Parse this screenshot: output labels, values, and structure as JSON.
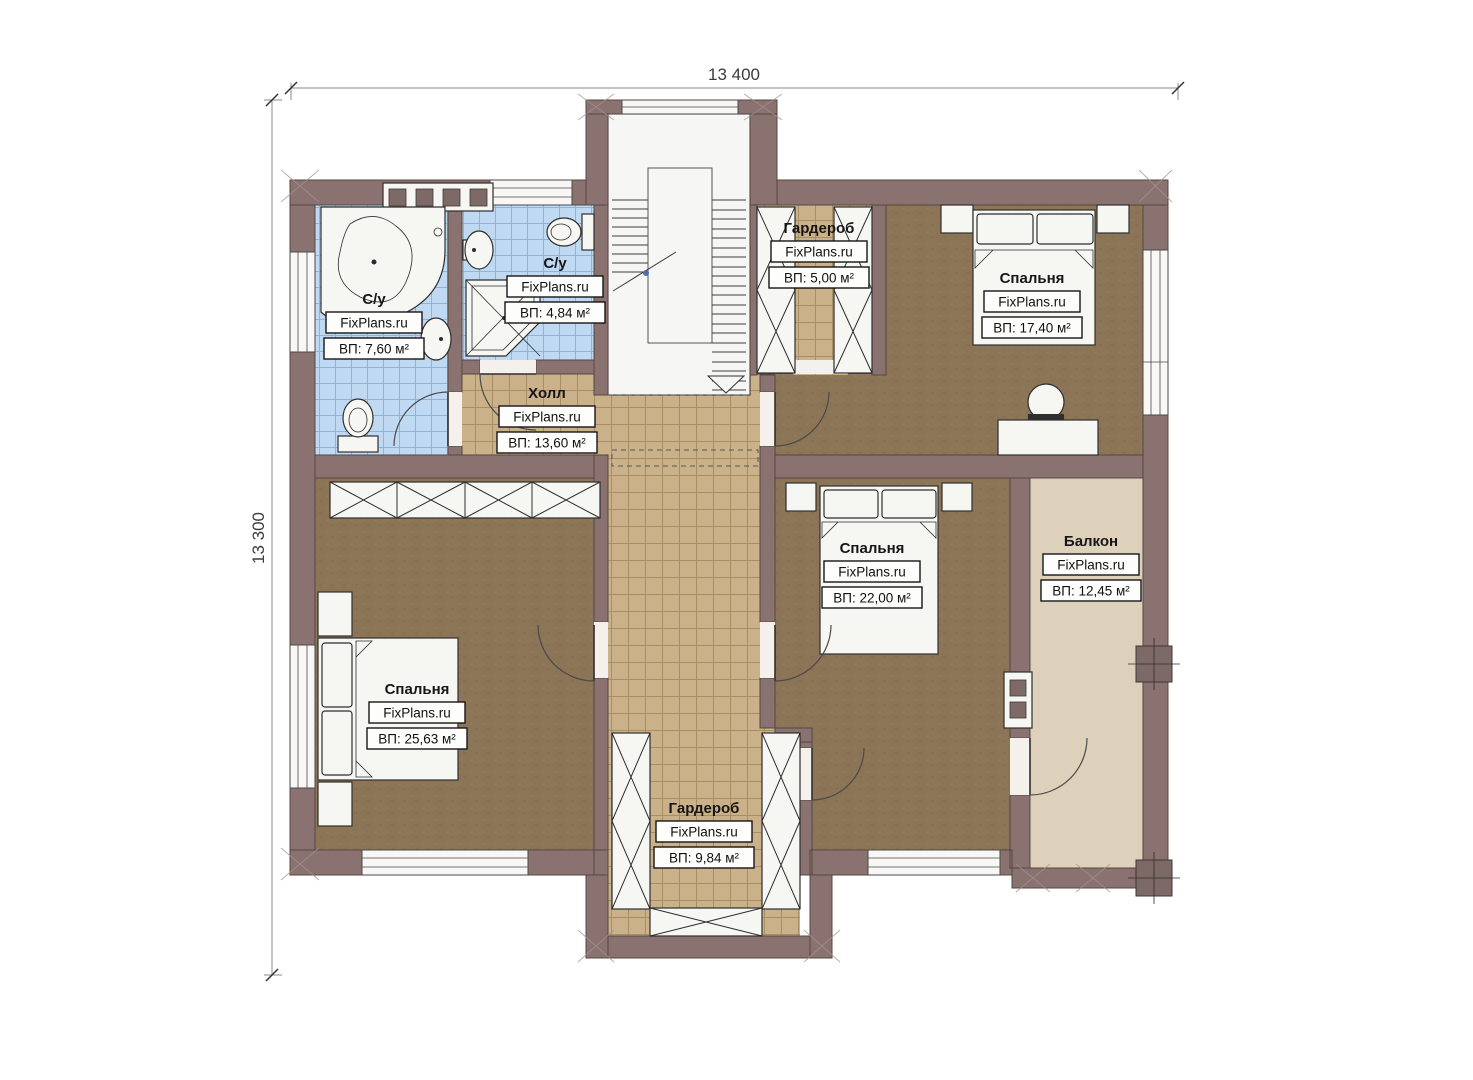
{
  "dimensions": {
    "top": "13 400",
    "left": "13 300"
  },
  "watermark": "FixPlans.ru",
  "colors": {
    "wall": "#8a7270",
    "bedroom_floor": "#8c7456",
    "hall_tile": "#cbb189",
    "bathroom_tile": "#c0d9f2",
    "balcony_floor": "#ded1bc",
    "fixture_white": "#f6f6f3"
  },
  "rooms": [
    {
      "id": "bathroom-1",
      "name": "С/у",
      "brand": "FixPlans.ru",
      "area": "ВП: 7,60 м²"
    },
    {
      "id": "bathroom-2",
      "name": "С/у",
      "brand": "FixPlans.ru",
      "area": "ВП: 4,84 м²"
    },
    {
      "id": "hall",
      "name": "Холл",
      "brand": "FixPlans.ru",
      "area": "ВП: 13,60 м²"
    },
    {
      "id": "wardrobe-top",
      "name": "Гардероб",
      "brand": "FixPlans.ru",
      "area": "ВП: 5,00 м²"
    },
    {
      "id": "bedroom-right",
      "name": "Спальня",
      "brand": "FixPlans.ru",
      "area": "ВП: 17,40 м²"
    },
    {
      "id": "bedroom-middle",
      "name": "Спальня",
      "brand": "FixPlans.ru",
      "area": "ВП: 22,00 м²"
    },
    {
      "id": "balcony",
      "name": "Балкон",
      "brand": "FixPlans.ru",
      "area": "ВП: 12,45 м²"
    },
    {
      "id": "bedroom-left",
      "name": "Спальня",
      "brand": "FixPlans.ru",
      "area": "ВП: 25,63 м²"
    },
    {
      "id": "wardrobe-bottom",
      "name": "Гардероб",
      "brand": "FixPlans.ru",
      "area": "ВП: 9,84 м²"
    }
  ]
}
